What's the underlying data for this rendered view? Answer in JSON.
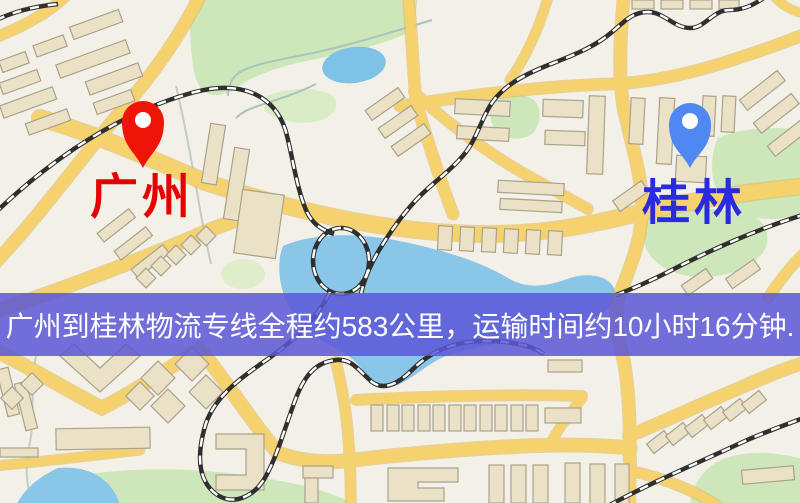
{
  "map": {
    "origin": {
      "label": "广州",
      "pin_icon": "red-map-pin-icon",
      "pin_color": "#ee1508",
      "label_color": "#e60000"
    },
    "destination": {
      "label": "桂林",
      "pin_icon": "blue-map-pin-icon",
      "pin_color": "#4f87f3",
      "label_color": "#2a2ae0"
    }
  },
  "banner": {
    "text": "广州到桂林物流专线全程约583公里，运输时间约10小时16分钟.",
    "distance_text": "约583公里",
    "duration_text": "约10小时16分钟",
    "background_color": "#5b57d6",
    "text_color": "#ffffff"
  },
  "palette": {
    "map_background": "#f3f0e8",
    "road": "#f5d26e",
    "road_casing": "#e3b94e",
    "water": "#8ac6e8",
    "park": "#cde7bb",
    "railway": "#2f2f2f",
    "building_fill": "#eae1c6",
    "building_stroke": "#a9a28c"
  }
}
